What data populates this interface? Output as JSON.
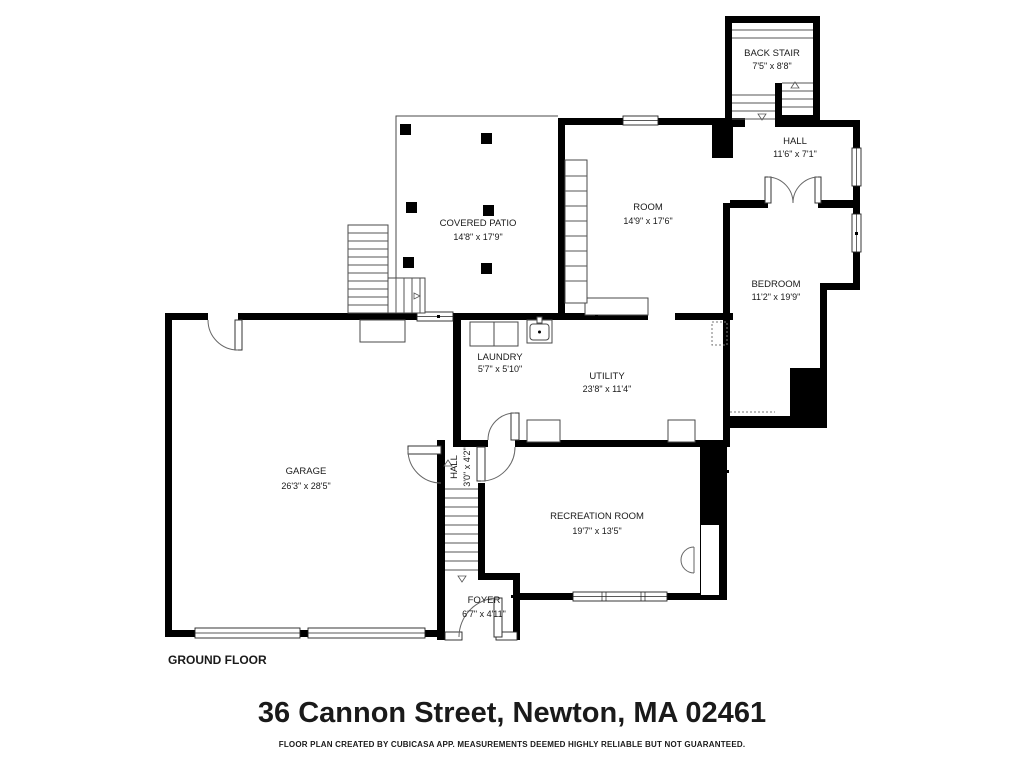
{
  "title": {
    "floor_label": "GROUND FLOOR",
    "address": "36 Cannon Street, Newton, MA 02461",
    "disclaimer": "FLOOR PLAN CREATED BY CUBICASA APP. MEASUREMENTS DEEMED HIGHLY RELIABLE BUT NOT GUARANTEED."
  },
  "rooms": {
    "back_stair": {
      "name": "BACK STAIR",
      "dims": "7'5\" x 8'8\""
    },
    "hall_upper": {
      "name": "HALL",
      "dims": "11'6\" x 7'1\""
    },
    "room": {
      "name": "ROOM",
      "dims": "14'9\" x 17'6\""
    },
    "covered_patio": {
      "name": "COVERED PATIO",
      "dims": "14'8\" x 17'9\""
    },
    "bedroom": {
      "name": "BEDROOM",
      "dims": "11'2\" x 19'9\""
    },
    "laundry": {
      "name": "LAUNDRY",
      "dims": "5'7\" x 5'10\""
    },
    "utility": {
      "name": "UTILITY",
      "dims": "23'8\" x 11'4\""
    },
    "garage": {
      "name": "GARAGE",
      "dims": "26'3\" x 28'5\""
    },
    "hall_lower": {
      "name": "HALL",
      "dims": "3'0\" x 4'2\""
    },
    "recreation_room": {
      "name": "RECREATION ROOM",
      "dims": "19'7\" x 13'5\""
    },
    "foyer": {
      "name": "FOYER",
      "dims": "6'7\" x 4'11\""
    }
  },
  "colors": {
    "wall": "#000000",
    "background": "#ffffff",
    "label_text": "#1a1a1a"
  }
}
